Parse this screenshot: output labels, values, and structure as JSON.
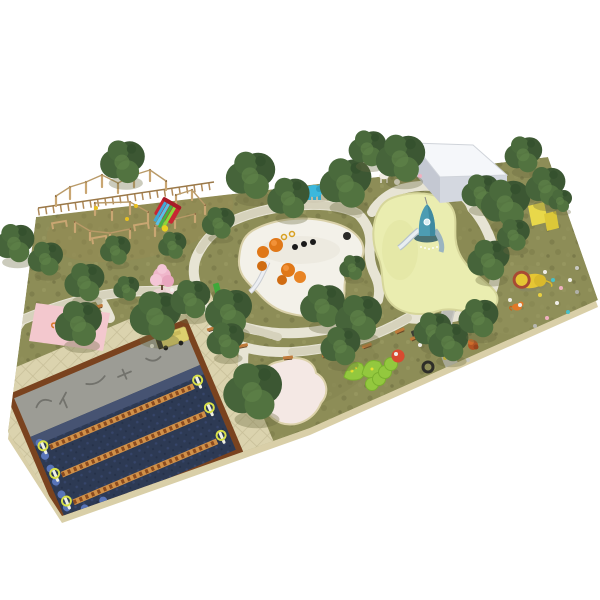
{
  "scene": {
    "description": "Aerial isometric 3D render of a landscaped children's playground park plan on a white background",
    "view": "isometric aerial render",
    "colors": {
      "background": "#ffffff",
      "grass": "#8d8d57",
      "slab_side": "#d9cfa8",
      "paving": "#dbd3ae",
      "path_light": "#e7e4d4",
      "path_gray": "#c9c9c3",
      "tree_dark": "#3c5733",
      "tree_mid": "#4a6a3c",
      "sand_white": "#f3f1e9",
      "sand_yellow": "#eaedb0",
      "sand_pink": "#f4e8e4",
      "sand_rim": "#d9d0a8",
      "rubber_navy": "#2d3a54",
      "rubber_gray": "#9c9c95",
      "border_brown": "#7a431f",
      "wood": "#c9a672",
      "building_top": "#f5f7fa",
      "building_side": "#d4d8e0",
      "building_left": "#c4c8d2",
      "rocket_teal": "#4d9cb2",
      "elephant_teal": "#3cb8dc",
      "lion_yellow": "#e6c633",
      "lion_mane": "#a84a34",
      "cherry_pink": "#efb6ca",
      "slide_red": "#c82633",
      "caterpillar_green": "#93c83e",
      "bench_orange": "#c07a3a",
      "bench_leg": "#6b4a28",
      "track_orange": "#d09048",
      "track_rung": "#8a4a1e",
      "arch_yellow": "#d8e048",
      "wall_yellow": "#e8d84a",
      "mushroom_orange": "#e07818",
      "mat_pink": "#f3c8ce",
      "bus_yellow": "#ddd06e",
      "tiger_orange": "#d8782a",
      "scallop_blue": "#5874b8"
    },
    "areas": [
      {
        "name": "grass-ground",
        "label": "Main lawn plot"
      },
      {
        "name": "white-sand-play-area",
        "label": "White sand play area with orange mushroom sculptures and slide"
      },
      {
        "name": "yellow-sand-play-area",
        "label": "Yellow sand area with blue rocket tower slide"
      },
      {
        "name": "pink-sand-pit",
        "label": "Pink sand pit"
      },
      {
        "name": "zipline-course",
        "label": "Navy rubber obstacle course with three equipment rows"
      },
      {
        "name": "plaza-paving",
        "label": "Paved plaza around obstacle course"
      },
      {
        "name": "service-building",
        "label": "White service building"
      },
      {
        "name": "rope-course",
        "label": "Timber pole rope-climbing course"
      },
      {
        "name": "red-slide",
        "label": "Red rainbow slide"
      },
      {
        "name": "cherry-tree",
        "label": "Pink blossom tree"
      },
      {
        "name": "elephant-sculpture",
        "label": "Blue elephant play sculpture"
      },
      {
        "name": "lion-sculpture",
        "label": "Yellow lion sculpture"
      },
      {
        "name": "caterpillar-climbers",
        "label": "Green caterpillar climbing structures"
      },
      {
        "name": "play-bus",
        "label": "Yellow bus play structure"
      },
      {
        "name": "pink-mat",
        "label": "Pink mat with tiger sculpture"
      },
      {
        "name": "climbing-wall",
        "label": "Yellow climbing wall"
      },
      {
        "name": "benches",
        "label": "Park benches"
      },
      {
        "name": "trees",
        "label": "Evergreen trees"
      },
      {
        "name": "winding-paths",
        "label": "Winding stone footpaths"
      }
    ],
    "trees": [
      {
        "x": 122,
        "y": 166,
        "s": 1.9
      },
      {
        "x": 250,
        "y": 180,
        "s": 2.1
      },
      {
        "x": 288,
        "y": 202,
        "s": 1.8
      },
      {
        "x": 345,
        "y": 188,
        "s": 2.2
      },
      {
        "x": 367,
        "y": 152,
        "s": 1.6
      },
      {
        "x": 400,
        "y": 163,
        "s": 2.1
      },
      {
        "x": 218,
        "y": 226,
        "s": 1.4
      },
      {
        "x": 172,
        "y": 248,
        "s": 1.2
      },
      {
        "x": 14,
        "y": 247,
        "s": 1.7
      },
      {
        "x": 45,
        "y": 262,
        "s": 1.5
      },
      {
        "x": 84,
        "y": 286,
        "s": 1.7
      },
      {
        "x": 115,
        "y": 253,
        "s": 1.3
      },
      {
        "x": 126,
        "y": 291,
        "s": 1.1
      },
      {
        "x": 78,
        "y": 328,
        "s": 2.0
      },
      {
        "x": 155,
        "y": 321,
        "s": 2.2
      },
      {
        "x": 190,
        "y": 303,
        "s": 1.7
      },
      {
        "x": 228,
        "y": 316,
        "s": 2.0
      },
      {
        "x": 252,
        "y": 397,
        "s": 2.5
      },
      {
        "x": 225,
        "y": 344,
        "s": 1.6
      },
      {
        "x": 322,
        "y": 310,
        "s": 1.9
      },
      {
        "x": 358,
        "y": 322,
        "s": 2.0
      },
      {
        "x": 340,
        "y": 350,
        "s": 1.7
      },
      {
        "x": 352,
        "y": 270,
        "s": 1.1
      },
      {
        "x": 480,
        "y": 196,
        "s": 1.6
      },
      {
        "x": 505,
        "y": 208,
        "s": 2.1
      },
      {
        "x": 523,
        "y": 158,
        "s": 1.6
      },
      {
        "x": 545,
        "y": 190,
        "s": 1.7
      },
      {
        "x": 560,
        "y": 203,
        "s": 1.0
      },
      {
        "x": 488,
        "y": 264,
        "s": 1.8
      },
      {
        "x": 432,
        "y": 334,
        "s": 1.6
      },
      {
        "x": 448,
        "y": 346,
        "s": 1.7
      },
      {
        "x": 478,
        "y": 322,
        "s": 1.7
      },
      {
        "x": 513,
        "y": 238,
        "s": 1.4
      }
    ],
    "scatter": [
      {
        "x": 545,
        "y": 272,
        "c": "#f0eee8"
      },
      {
        "x": 553,
        "y": 280,
        "c": "#48c0c8"
      },
      {
        "x": 561,
        "y": 288,
        "c": "#f0b0c0"
      },
      {
        "x": 570,
        "y": 280,
        "c": "#f0eee8"
      },
      {
        "x": 577,
        "y": 292,
        "c": "#b0b0a8"
      },
      {
        "x": 540,
        "y": 295,
        "c": "#e8d040"
      },
      {
        "x": 557,
        "y": 303,
        "c": "#f0eee8"
      },
      {
        "x": 568,
        "y": 312,
        "c": "#48c0c8"
      },
      {
        "x": 547,
        "y": 318,
        "c": "#f0b0c0"
      },
      {
        "x": 535,
        "y": 326,
        "c": "#b8b8b0"
      },
      {
        "x": 520,
        "y": 305,
        "c": "#f0eee8"
      },
      {
        "x": 577,
        "y": 268,
        "c": "#c8c8c0"
      },
      {
        "x": 452,
        "y": 350,
        "c": "#f0eee8"
      },
      {
        "x": 460,
        "y": 355,
        "c": "#48c0c8"
      },
      {
        "x": 468,
        "y": 360,
        "c": "#c8c8c0"
      },
      {
        "x": 445,
        "y": 358,
        "c": "#e8d040"
      },
      {
        "x": 420,
        "y": 345,
        "c": "#f0eee8"
      },
      {
        "x": 136,
        "y": 206,
        "c": "#e8c020"
      },
      {
        "x": 127,
        "y": 219,
        "c": "#e8c020"
      },
      {
        "x": 96,
        "y": 208,
        "c": "#e8c020"
      },
      {
        "x": 172,
        "y": 290,
        "c": "#f0eee8"
      },
      {
        "x": 176,
        "y": 293,
        "c": "#44443c"
      },
      {
        "x": 152,
        "y": 346,
        "c": "#f0eee8"
      },
      {
        "x": 510,
        "y": 300,
        "c": "#f0eee8"
      },
      {
        "x": 420,
        "y": 176,
        "c": "#f0b0c0"
      },
      {
        "x": 414,
        "y": 170,
        "c": "#48c0c8"
      }
    ],
    "benches": [
      {
        "x": 212,
        "y": 329,
        "r": -18
      },
      {
        "x": 243,
        "y": 346,
        "r": -12
      },
      {
        "x": 288,
        "y": 358,
        "r": -6
      },
      {
        "x": 327,
        "y": 356,
        "r": -4
      },
      {
        "x": 367,
        "y": 346,
        "r": -20
      },
      {
        "x": 400,
        "y": 331,
        "r": -24
      },
      {
        "x": 415,
        "y": 338,
        "r": -24
      },
      {
        "x": 98,
        "y": 307,
        "r": -15
      }
    ],
    "course_poles": [
      {
        "x": 56,
        "y": 206,
        "h": 10
      },
      {
        "x": 70,
        "y": 199,
        "h": 12
      },
      {
        "x": 86,
        "y": 193,
        "h": 11
      },
      {
        "x": 102,
        "y": 187,
        "h": 12
      },
      {
        "x": 118,
        "y": 193,
        "h": 10
      },
      {
        "x": 134,
        "y": 187,
        "h": 12
      },
      {
        "x": 150,
        "y": 181,
        "h": 11
      },
      {
        "x": 166,
        "y": 190,
        "h": 9
      },
      {
        "x": 95,
        "y": 215,
        "h": 12
      },
      {
        "x": 112,
        "y": 220,
        "h": 10
      },
      {
        "x": 130,
        "y": 214,
        "h": 12
      },
      {
        "x": 148,
        "y": 222,
        "h": 10
      },
      {
        "x": 176,
        "y": 206,
        "h": 11
      },
      {
        "x": 192,
        "y": 200,
        "h": 10
      },
      {
        "x": 205,
        "y": 214,
        "h": 9
      },
      {
        "x": 75,
        "y": 232,
        "h": 10
      },
      {
        "x": 90,
        "y": 240,
        "h": 9
      },
      {
        "x": 110,
        "y": 243,
        "h": 10
      },
      {
        "x": 130,
        "y": 238,
        "h": 9
      },
      {
        "x": 155,
        "y": 236,
        "h": 10
      },
      {
        "x": 175,
        "y": 228,
        "h": 9
      },
      {
        "x": 195,
        "y": 222,
        "h": 8
      }
    ],
    "track_rows": [
      {
        "y": -8
      },
      {
        "y": 22
      },
      {
        "y": 52
      }
    ]
  }
}
